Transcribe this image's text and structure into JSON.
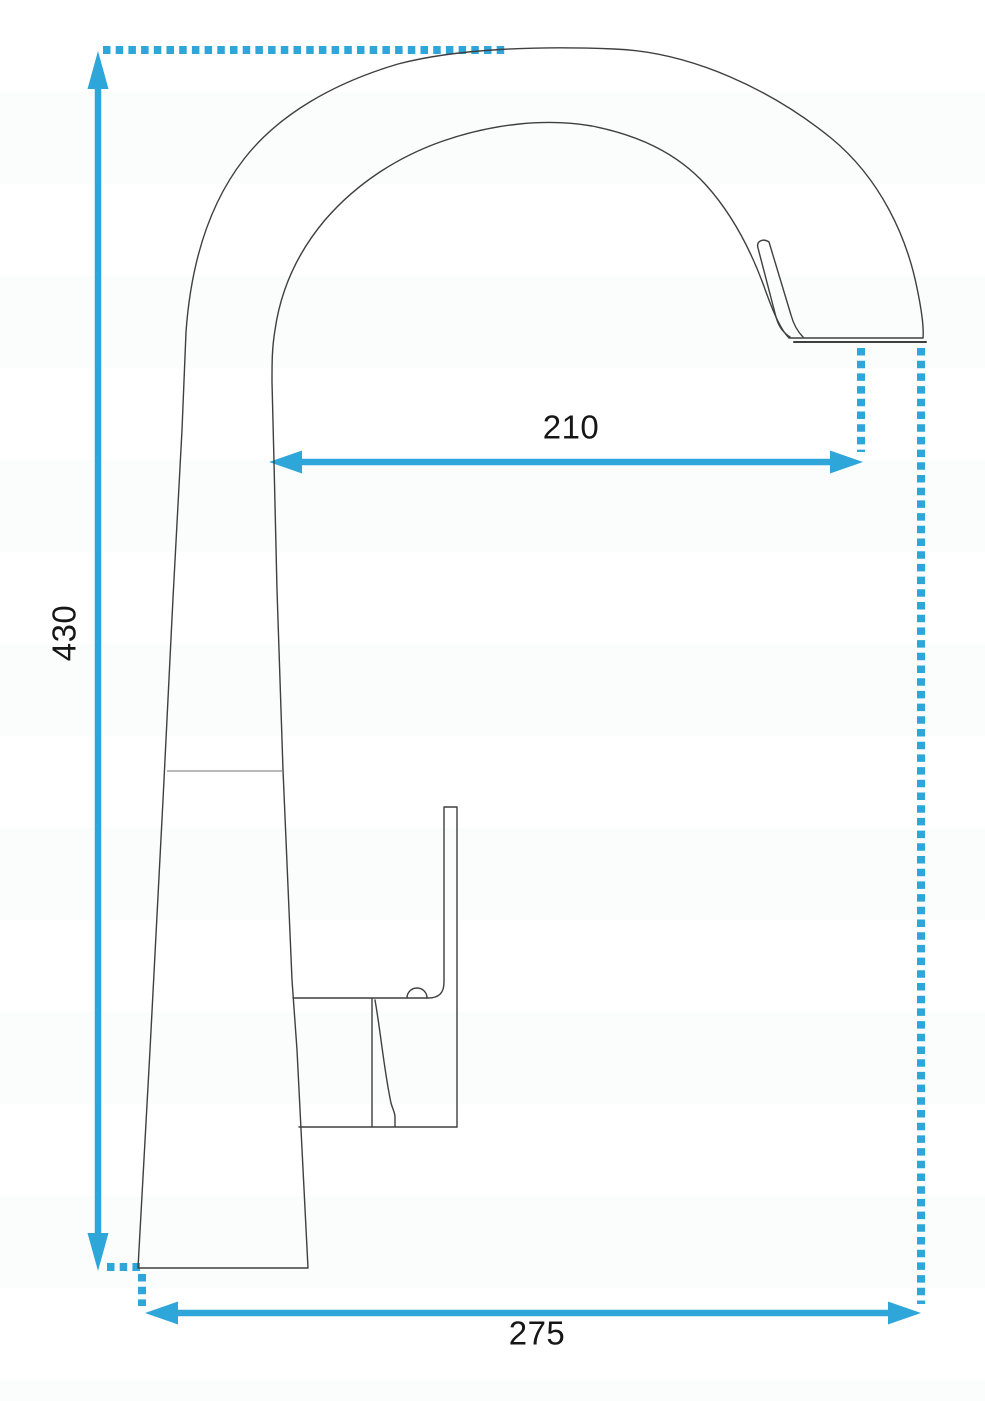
{
  "diagram": {
    "type": "technical dimension drawing",
    "subject": "kitchen faucet with high arc pull-out spout, side view",
    "dimension_labels": {
      "height": "430",
      "spout_reach": "210",
      "base_width": "275"
    },
    "colors": {
      "dimension": "#2ea6d9",
      "outline": "#3f3f3f",
      "secondary_line": "#8f8f8f",
      "label_text": "#161616",
      "background": "#ffffff"
    }
  }
}
